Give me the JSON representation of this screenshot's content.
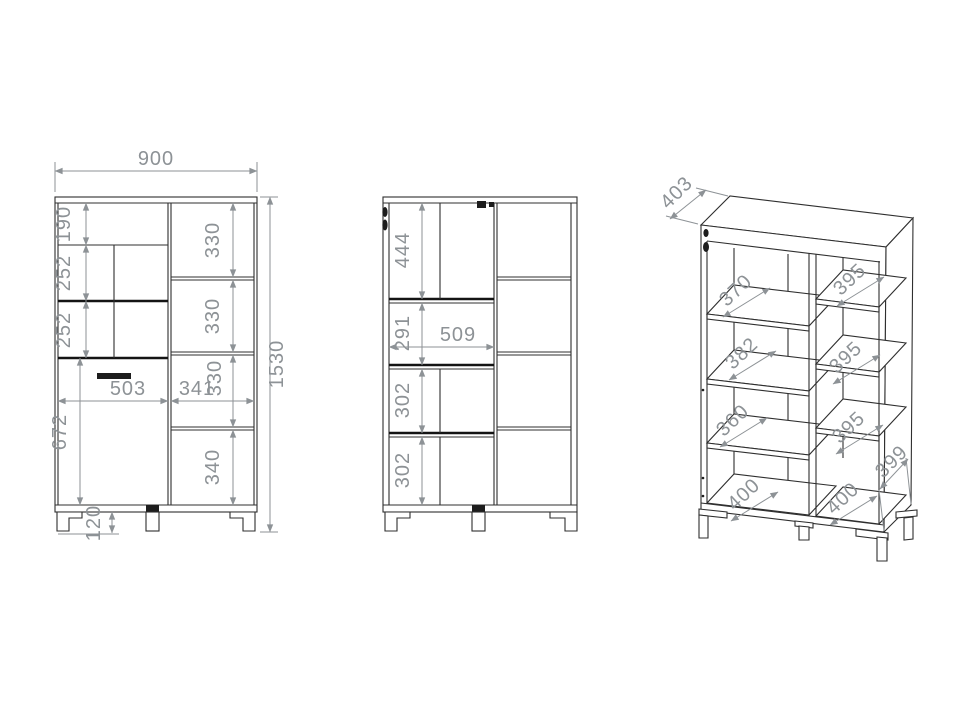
{
  "views": {
    "front": {
      "total_width": "900",
      "total_height": "1530",
      "left_column_heights": [
        "190",
        "252",
        "252",
        "672"
      ],
      "right_column_heights": [
        "330",
        "330",
        "330",
        "340"
      ],
      "door_width": "503",
      "right_column_width": "341",
      "leg_height": "120"
    },
    "interior": {
      "left_column_heights": [
        "444",
        "291",
        "302",
        "302"
      ],
      "interior_width": "509"
    },
    "perspective": {
      "top_depth": "403",
      "left_shelf_depths": [
        "370",
        "382",
        "360",
        "400"
      ],
      "right_shelf_depths": [
        "395",
        "395",
        "395",
        "400"
      ],
      "bottom_side_depth": "399"
    }
  },
  "colors": {
    "background": "#ffffff",
    "drawing_line": "#2f2f2f",
    "heavy_line": "#141414",
    "dimension": "#8d9296",
    "handle_black": "#1d1d1d"
  }
}
